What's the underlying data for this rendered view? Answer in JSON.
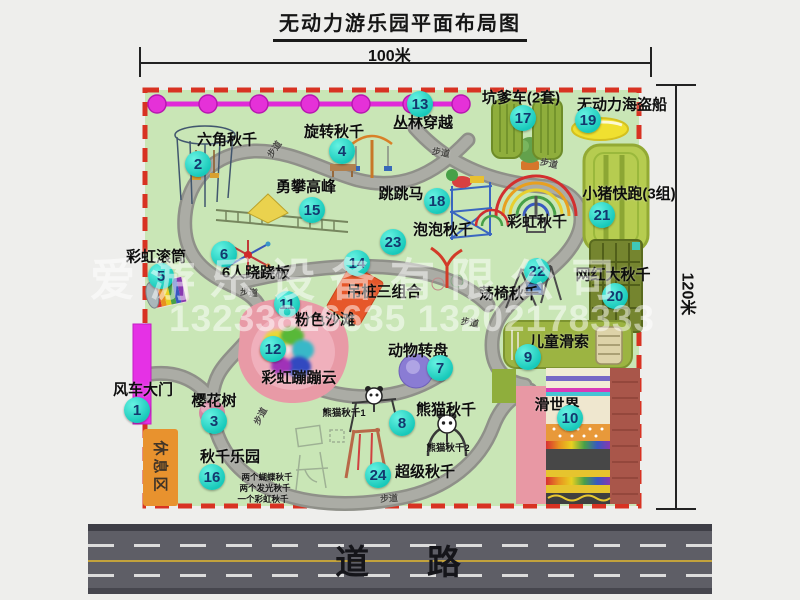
{
  "title": "无动力游乐园平面布局图",
  "dimensions": {
    "width_label": "100米",
    "height_label": "120米"
  },
  "road": {
    "label": "道    路"
  },
  "rest_area": {
    "label": "休息区"
  },
  "watermark": {
    "line1": "爱游乐设备有限公司",
    "line2": "13233816635 13202178333"
  },
  "colors": {
    "park_green": "#c9e6b6",
    "boundary_red": "#d83222",
    "marker_teal": "#17c9ba",
    "chain_magenta": "#e02ad8",
    "gate_magenta": "#e531e5",
    "rest_orange": "#e8922e",
    "road_gray": "#5e5e66"
  },
  "markers": [
    {
      "num": "1",
      "label": "风车大门",
      "cx": 137,
      "cy": 410,
      "lx": 143,
      "ly": 389
    },
    {
      "num": "2",
      "label": "六角秋千",
      "cx": 198,
      "cy": 164,
      "lx": 227,
      "ly": 139
    },
    {
      "num": "3",
      "label": "樱花树",
      "cx": 214,
      "cy": 421,
      "lx": 214,
      "ly": 400
    },
    {
      "num": "4",
      "label": "旋转秋千",
      "cx": 342,
      "cy": 151,
      "lx": 334,
      "ly": 131
    },
    {
      "num": "5",
      "label": "彩虹滚筒",
      "cx": 161,
      "cy": 276,
      "lx": 156,
      "ly": 256
    },
    {
      "num": "6",
      "label": "6人跷跷板",
      "cx": 224,
      "cy": 254,
      "lx": 256,
      "ly": 272
    },
    {
      "num": "7",
      "label": "动物转盘",
      "cx": 440,
      "cy": 368,
      "lx": 418,
      "ly": 350
    },
    {
      "num": "8",
      "label": "熊猫秋千",
      "cx": 402,
      "cy": 423,
      "lx": 446,
      "ly": 409
    },
    {
      "num": "9",
      "label": "儿童滑索",
      "cx": 528,
      "cy": 357,
      "lx": 559,
      "ly": 341
    },
    {
      "num": "10",
      "label": "滑世界",
      "cx": 570,
      "cy": 418,
      "lx": 557,
      "ly": 404
    },
    {
      "num": "11",
      "label": "粉色沙滩",
      "cx": 287,
      "cy": 304,
      "lx": 325,
      "ly": 319
    },
    {
      "num": "12",
      "label": "彩虹蹦蹦云",
      "cx": 273,
      "cy": 349,
      "lx": 299,
      "ly": 377
    },
    {
      "num": "13",
      "label": "丛林穿越",
      "cx": 420,
      "cy": 104,
      "lx": 423,
      "ly": 122
    },
    {
      "num": "14",
      "label": "吊桩三组合",
      "cx": 357,
      "cy": 263,
      "lx": 384,
      "ly": 291
    },
    {
      "num": "15",
      "label": "勇攀高峰",
      "cx": 312,
      "cy": 210,
      "lx": 306,
      "ly": 186
    },
    {
      "num": "16",
      "label": "秋千乐园",
      "cx": 212,
      "cy": 477,
      "lx": 230,
      "ly": 456
    },
    {
      "num": "17",
      "label": "坑爹车(2套)",
      "cx": 523,
      "cy": 118,
      "lx": 521,
      "ly": 97
    },
    {
      "num": "18",
      "label": "跳跳马",
      "cx": 437,
      "cy": 201,
      "lx": 401,
      "ly": 193
    },
    {
      "num": "19",
      "label": "无动力海盗船",
      "cx": 588,
      "cy": 120,
      "lx": 622,
      "ly": 104
    },
    {
      "num": "20",
      "label": "网红大秋千",
      "cx": 615,
      "cy": 296,
      "lx": 613,
      "ly": 274
    },
    {
      "num": "21",
      "label": "小猪快跑(3组)",
      "cx": 602,
      "cy": 215,
      "lx": 629,
      "ly": 193
    },
    {
      "num": "22",
      "label": "荡椅秋千",
      "cx": 537,
      "cy": 271,
      "lx": 509,
      "ly": 293
    },
    {
      "num": "23",
      "label": "泡泡秋千",
      "cx": 393,
      "cy": 242,
      "lx": 443,
      "ly": 229
    },
    {
      "num": "24",
      "label": "超级秋千",
      "cx": 378,
      "cy": 475,
      "lx": 425,
      "ly": 471
    }
  ],
  "extra_labels": [
    {
      "text": "彩虹秋千",
      "x": 537,
      "y": 221,
      "size": 15,
      "name": "label-rainbow-swing"
    },
    {
      "text": "熊猫秋千1",
      "x": 344,
      "y": 412,
      "size": 9.5,
      "name": "label-panda-swing-1"
    },
    {
      "text": "熊猫秋千2",
      "x": 448,
      "y": 447,
      "size": 9.5,
      "name": "label-panda-swing-2"
    },
    {
      "text": "两个蝴蝶秋千",
      "x": 267,
      "y": 477,
      "size": 8.5,
      "name": "label-swing-note-1"
    },
    {
      "text": "两个发光秋千",
      "x": 265,
      "y": 488,
      "size": 8.5,
      "name": "label-swing-note-2"
    },
    {
      "text": "一个彩虹秋千",
      "x": 263,
      "y": 499,
      "size": 8.5,
      "name": "label-swing-note-3"
    },
    {
      "text": "步道",
      "x": 274,
      "y": 149,
      "size": 9,
      "rot": -55,
      "color": "#4a4a46",
      "name": "path-label"
    },
    {
      "text": "步道",
      "x": 441,
      "y": 152,
      "size": 9,
      "rot": 10,
      "color": "#4a4a46",
      "name": "path-label"
    },
    {
      "text": "步道",
      "x": 549,
      "y": 163,
      "size": 9,
      "rot": 12,
      "color": "#4a4a46",
      "name": "path-label"
    },
    {
      "text": "步道",
      "x": 249,
      "y": 292,
      "size": 9,
      "rot": 4,
      "color": "#4a4a46",
      "name": "path-label"
    },
    {
      "text": "步道",
      "x": 470,
      "y": 322,
      "size": 9,
      "rot": 10,
      "color": "#4a4a46",
      "name": "path-label"
    },
    {
      "text": "步道",
      "x": 260,
      "y": 416,
      "size": 9,
      "rot": -62,
      "color": "#4a4a46",
      "name": "path-label"
    },
    {
      "text": "步道",
      "x": 389,
      "y": 498,
      "size": 9,
      "rot": -3,
      "color": "#4a4a46",
      "name": "path-label"
    }
  ]
}
